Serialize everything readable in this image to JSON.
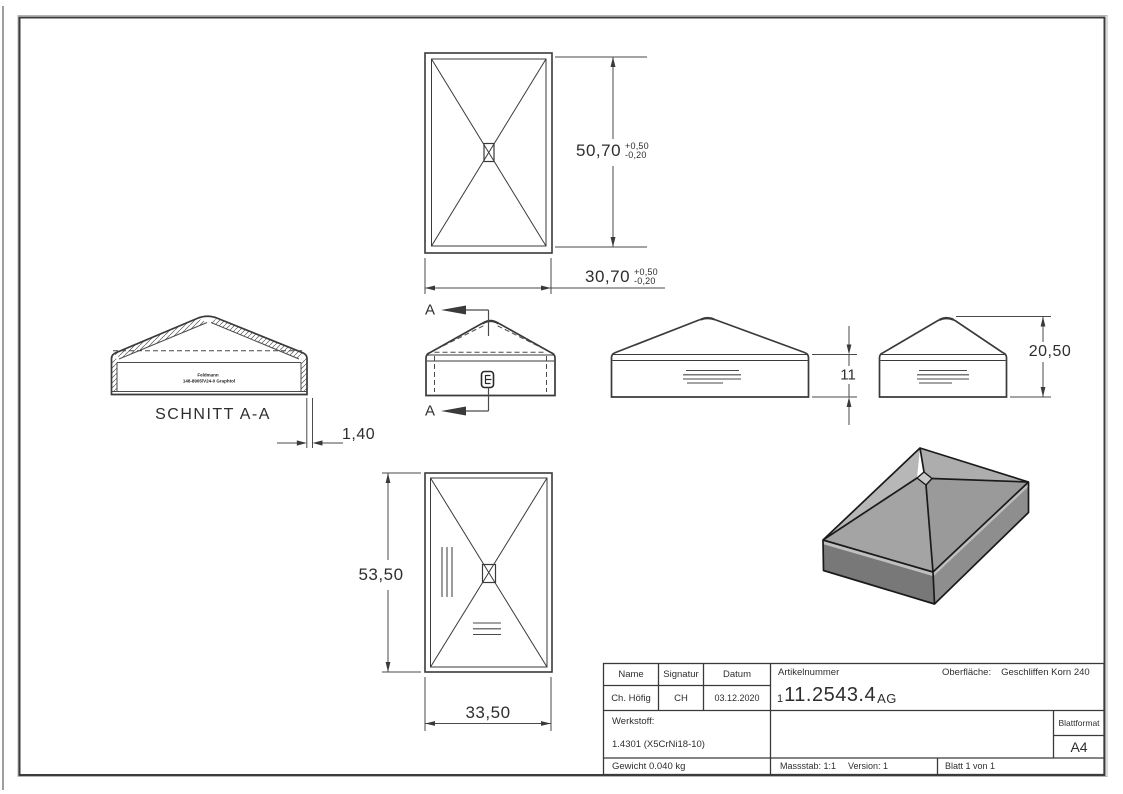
{
  "drawing": {
    "section_label": "SCHNITT A-A",
    "cut_letter": "A",
    "stamp_line1": "Feldmann",
    "stamp_line2": "148-8905/V24-0 Graphtol",
    "dims": {
      "top_height": "50,70",
      "top_width": "30,70",
      "tol_plus": "+0,50",
      "tol_minus": "-0,20",
      "wall_thickness": "1,40",
      "band_height": "11",
      "total_height": "20,50",
      "bottom_height": "53,50",
      "bottom_width": "33,50"
    }
  },
  "title_block": {
    "name_label": "Name",
    "signatur_label": "Signatur",
    "datum_label": "Datum",
    "name_value": "Ch. Höfig",
    "signatur_value": "CH",
    "datum_value": "03.12.2020",
    "artikelnummer_label": "Artikelnummer",
    "artikelnummer_prefix": "1",
    "artikelnummer_main": "11.2543.4",
    "artikelnummer_suffix": "AG",
    "oberflaeche_label": "Oberfläche:",
    "oberflaeche_value": "Geschliffen Korn 240",
    "werkstoff_label": "Werkstoff:",
    "werkstoff_value": "1.4301 (X5CrNi18-10)",
    "blattformat_label": "Blattformat",
    "blattformat_value": "A4",
    "gewicht_value": "Gewicht 0.040 kg",
    "massstab_value": "Massstab: 1:1",
    "version_value": "Version: 1",
    "blatt_value": "Blatt 1 von 1"
  }
}
